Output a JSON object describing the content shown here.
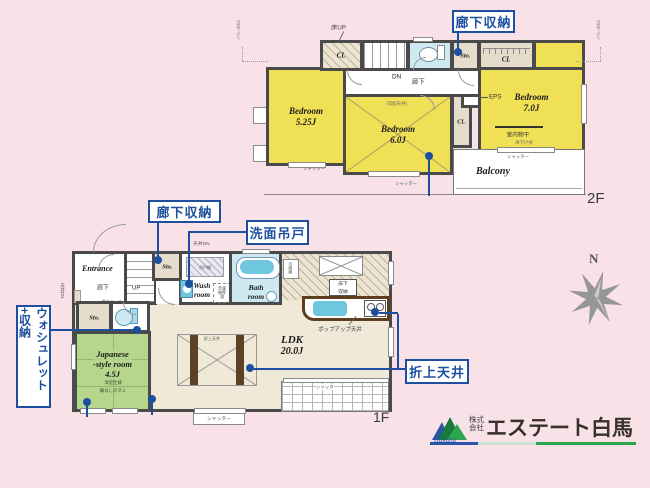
{
  "palette": {
    "background": "#f8e2e8",
    "room_yellow": "#f0e055",
    "room_green": "#b5d68c",
    "room_beige": "#f0e9d7",
    "room_tan": "#e6dccb",
    "water_blue": "#cfe9f2",
    "fixture_blue": "#6ec7df",
    "wall": "#4a4a4a",
    "callout_blue": "#1e4f9f",
    "counter_brown": "#5d3e1e",
    "logo_green": "#2fa44e",
    "logo_blue": "#2a56a8"
  },
  "floor2": {
    "floor_label": "2F",
    "bedroom1_name": "Bedroom",
    "bedroom1_size": "5.25J",
    "bedroom2_name": "Bedroom",
    "bedroom2_size": "6.0J",
    "bedroom2_note": "(勾配天井)",
    "bedroom3_name": "Bedroom",
    "bedroom3_size": "7.0J",
    "balcony": "Balcony",
    "hallway": "廊下",
    "floor_up": "床UP",
    "down": "DN",
    "eps": "EPS",
    "indoor_drying": "室内物干",
    "drying_note": "吊下げ式",
    "roof_note": "母屋下がり"
  },
  "floor1": {
    "floor_label": "1F",
    "entrance": "Entrance",
    "hallway": "廊下",
    "niche": "飾りニッチ",
    "up": "UP",
    "wash_room": "Wash room",
    "wash_cabinet": "吊戸棚",
    "laundry": "洗濯機置場",
    "bath_room": "Bath room",
    "fridge": "冷蔵庫",
    "underfloor1": "床下",
    "underfloor2": "収納",
    "popup_ceiling": "ポップアップ天井",
    "ldk_name": "LDK",
    "ldk_size": "20.0J",
    "coffered_note": "折上天井",
    "jroom_name1": "Japanese",
    "jroom_name2": "-style room",
    "jroom_size": "4.5J",
    "jroom_note1": "洋室仕様",
    "jroom_note2": "縁なしタタミ"
  },
  "labels": {
    "cl": "CL",
    "sto": "Sto.",
    "shutter": "シャッター",
    "ceiling_dn": "天井DN"
  },
  "callouts": {
    "hallway_storage_2f": "廊下収納",
    "hallway_storage_1f": "廊下収納",
    "wash_cabinet": "洗面吊戸",
    "washlet_storage": "ウォシュレット+収納",
    "coffered_ceiling": "折上天井"
  },
  "compass": {
    "north": "N"
  },
  "logo": {
    "prefix1": "株式",
    "prefix2": "会社",
    "company": "エステート白馬",
    "script": "Hakuba"
  }
}
